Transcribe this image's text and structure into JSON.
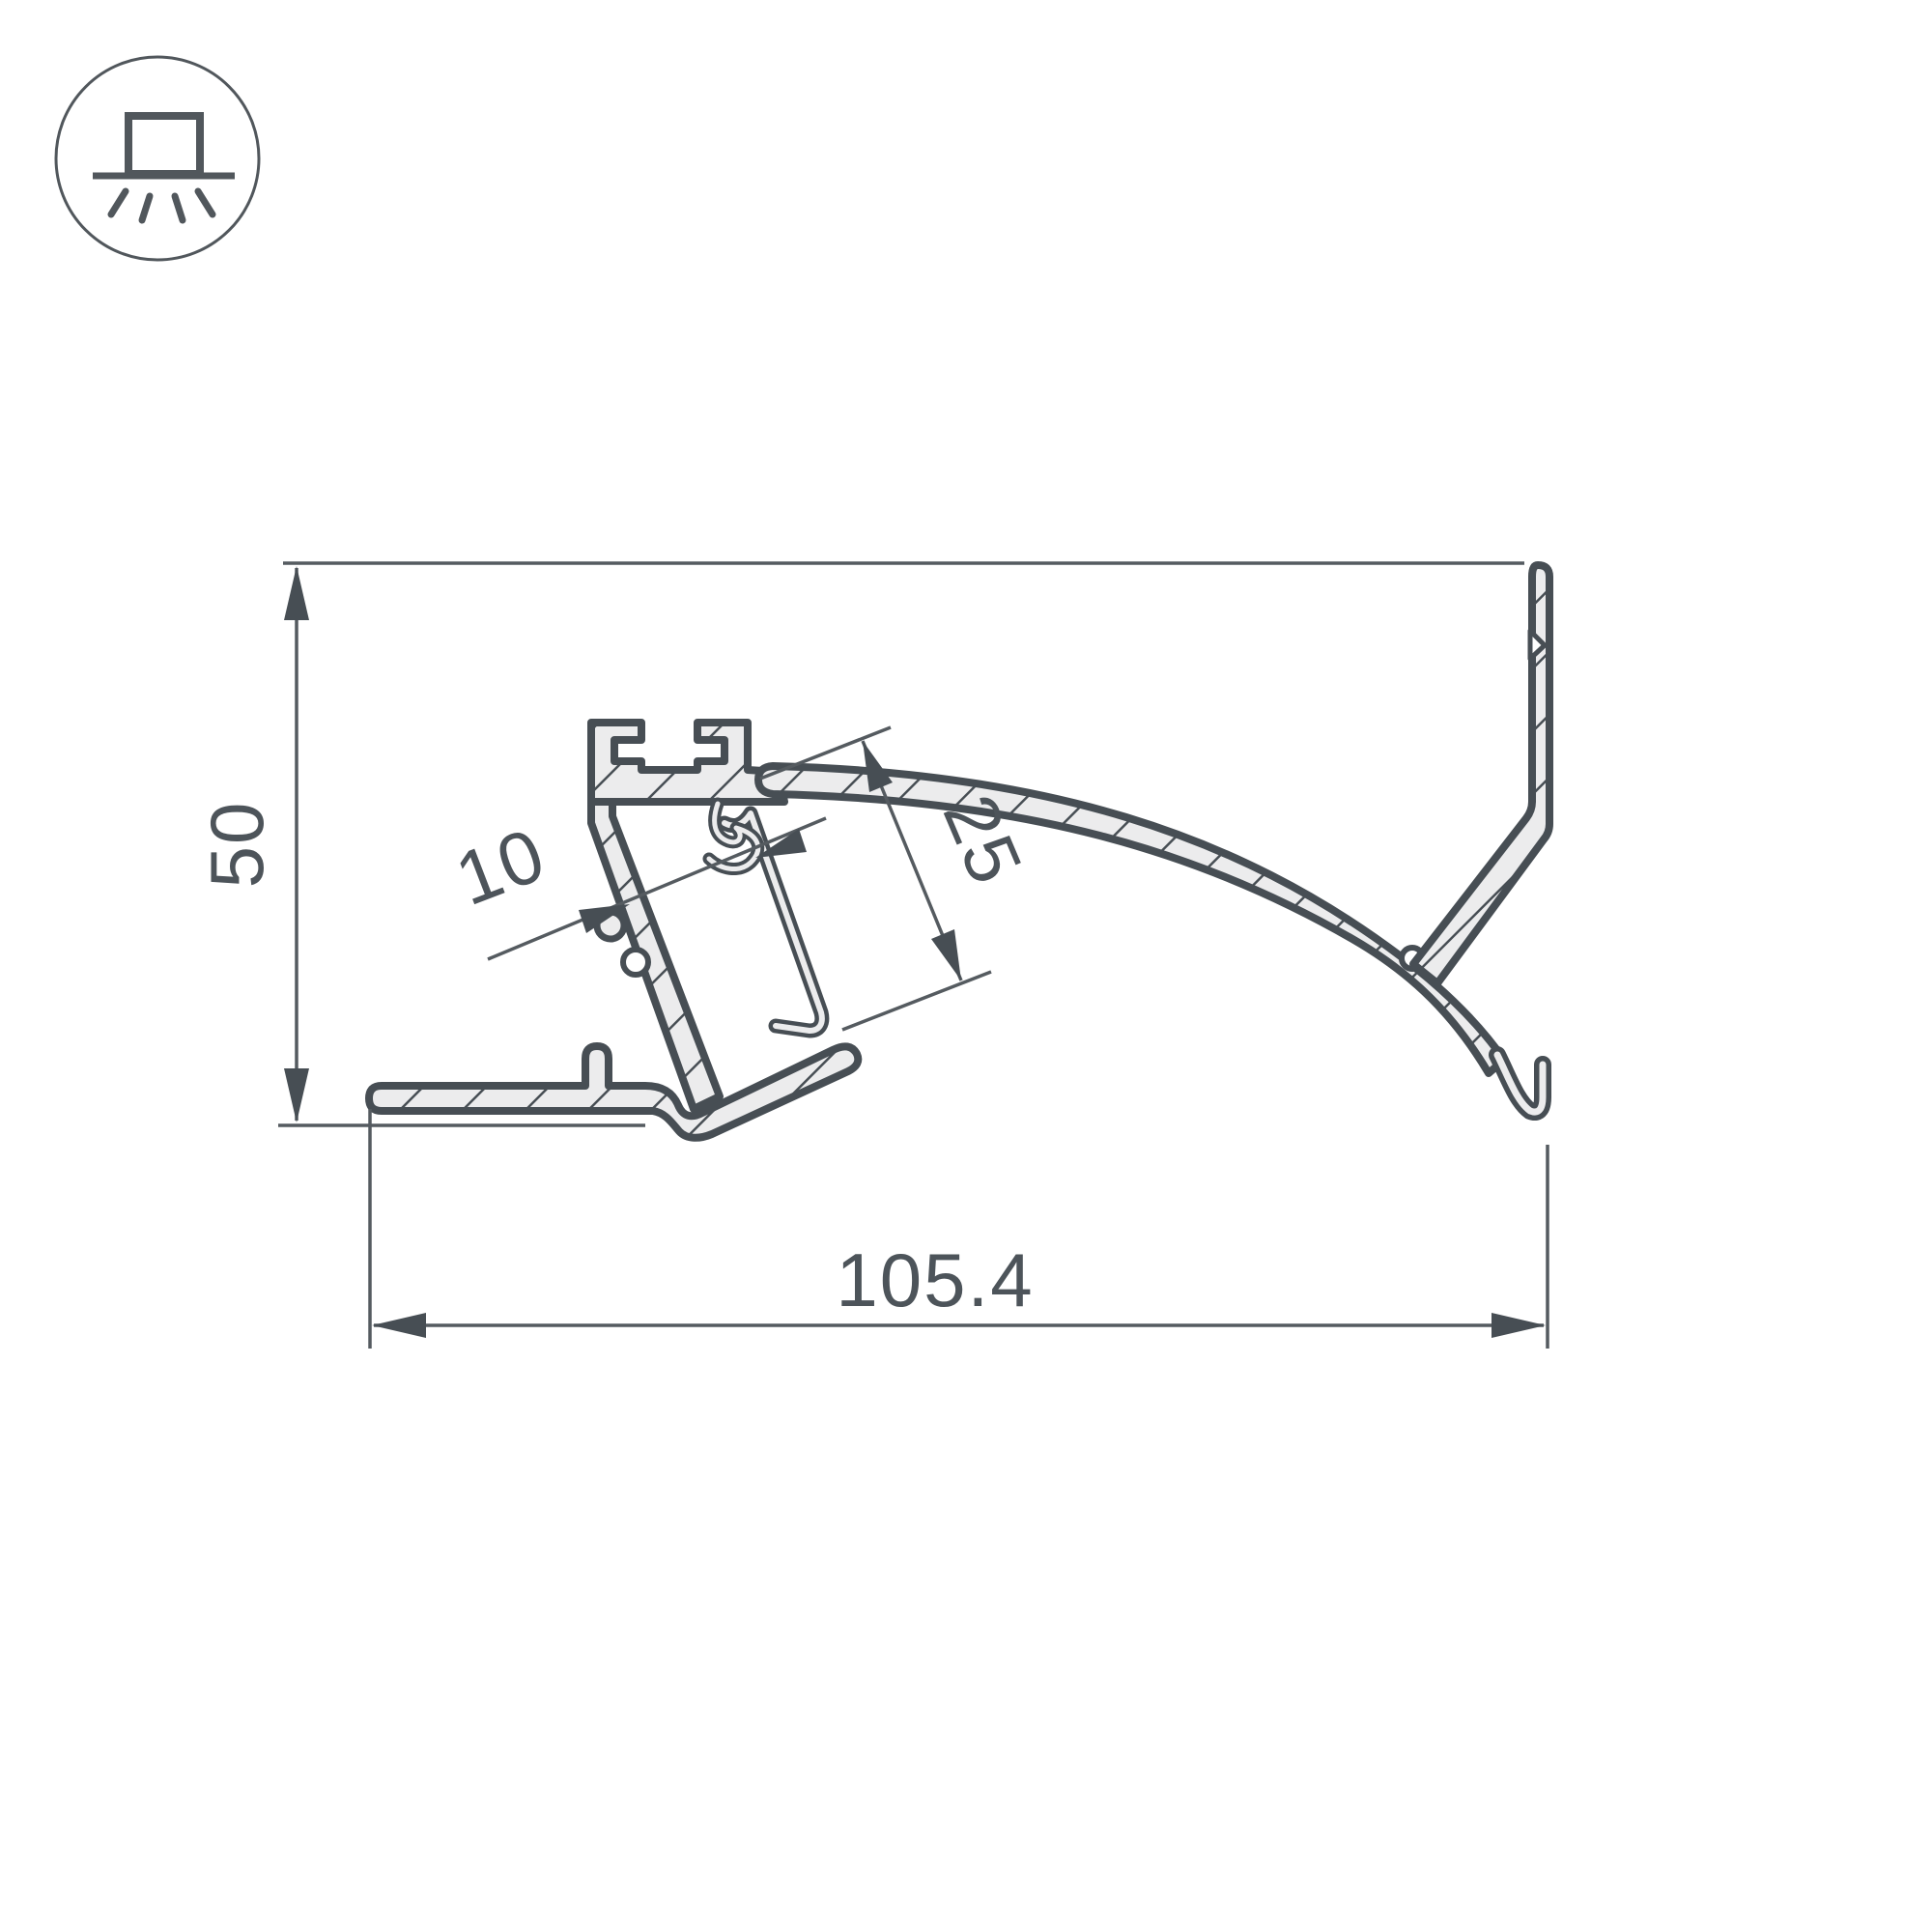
{
  "drawing": {
    "type": "profile-cross-section",
    "icon": "surface-mounted-light-icon",
    "colors": {
      "outline": "#474e54",
      "thin_line": "#555b60",
      "section_fill": "#ececed",
      "background": "#ffffff"
    },
    "dimensions": {
      "height": "50",
      "width": "105.4",
      "opening": "25",
      "channel": "10"
    }
  }
}
